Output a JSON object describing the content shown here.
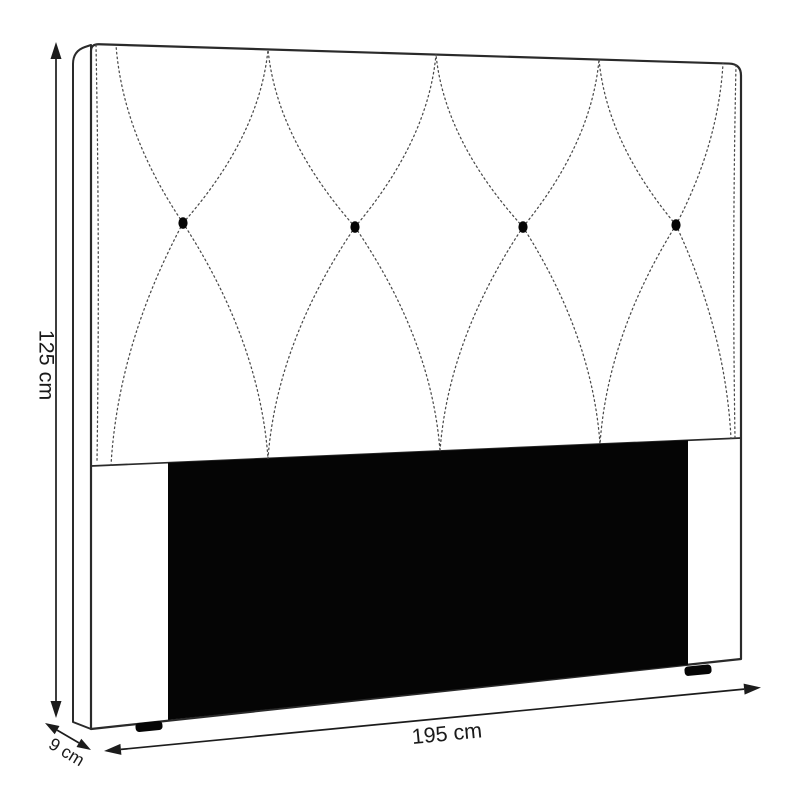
{
  "diagram": {
    "kind": "furniture-dimension-diagram",
    "subject": "upholstered tufted headboard, front three-quarter view",
    "background_color": "#ffffff",
    "line_color": "#2a2a2a",
    "panel_color": "#050505",
    "dimensions": {
      "height_label": "125 cm",
      "width_label": "195 cm",
      "depth_label": "9 cm"
    },
    "features": {
      "tufting_buttons_count": 4,
      "stitch_pattern": "diamond cross stitching (dotted lines)",
      "recessed_lower_panel": "black rectangle",
      "feet_count": 2
    }
  }
}
